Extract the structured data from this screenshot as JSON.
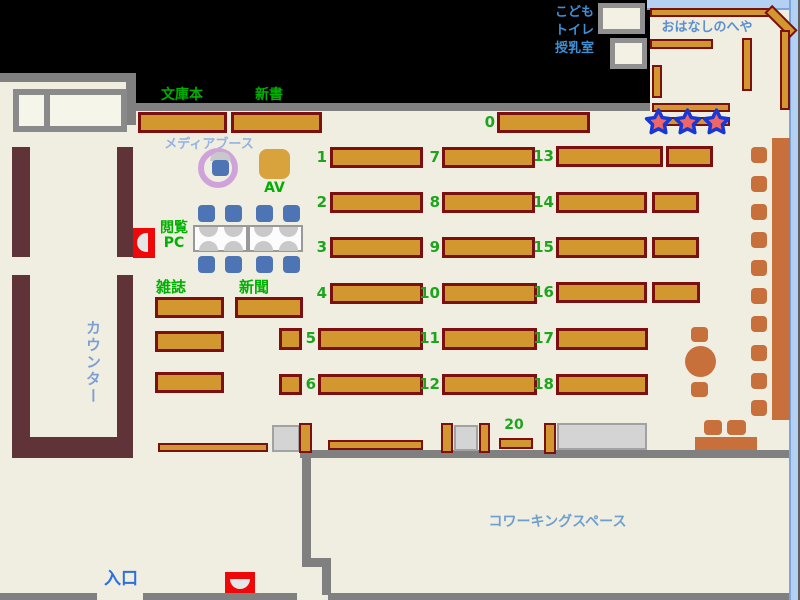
{
  "labels": {
    "kids_line1": "こども",
    "kids_line2": "トイレ",
    "kids_line3": "授乳室",
    "storytime_room": "おはなしのへや",
    "bunkobon": "文庫本",
    "shinsho": "新書",
    "media_booth": "メディアブース",
    "av": "AV",
    "pc_line1": "閲覧",
    "pc_line2": "PC",
    "magazines": "雑誌",
    "newspapers": "新聞",
    "counter": "カウンター",
    "entrance": "入口",
    "coworking": "コワーキングスペース"
  },
  "shelves": {
    "n0": "0",
    "n1": "1",
    "n2": "2",
    "n3": "3",
    "n4": "4",
    "n5": "5",
    "n6": "6",
    "n7": "7",
    "n8": "8",
    "n9": "9",
    "n10": "10",
    "n11": "11",
    "n12": "12",
    "n13": "13",
    "n14": "14",
    "n15": "15",
    "n16": "16",
    "n17": "17",
    "n18": "18",
    "n20": "20"
  },
  "icons": {
    "stars": "star-icon",
    "return_slots": "return-slot-icon"
  },
  "colors": {
    "floor": "#f0eee0",
    "shelf": "#d2982f",
    "shelf_border": "#7c1010",
    "counter_wall": "#5f3338",
    "wall": "#808080",
    "blue_wall": "#b4d0f2",
    "sienna_furniture": "#c8703c",
    "chair_blue": "#4d74b5",
    "label_green": "#1ea51e",
    "label_blue": "#5b8fd0",
    "entrance_blue": "#2b6fe3",
    "star_fill": "#f06565",
    "star_stroke": "#1538d8",
    "marker_red": "#ee0808",
    "media_ring": "#cfa3da"
  }
}
